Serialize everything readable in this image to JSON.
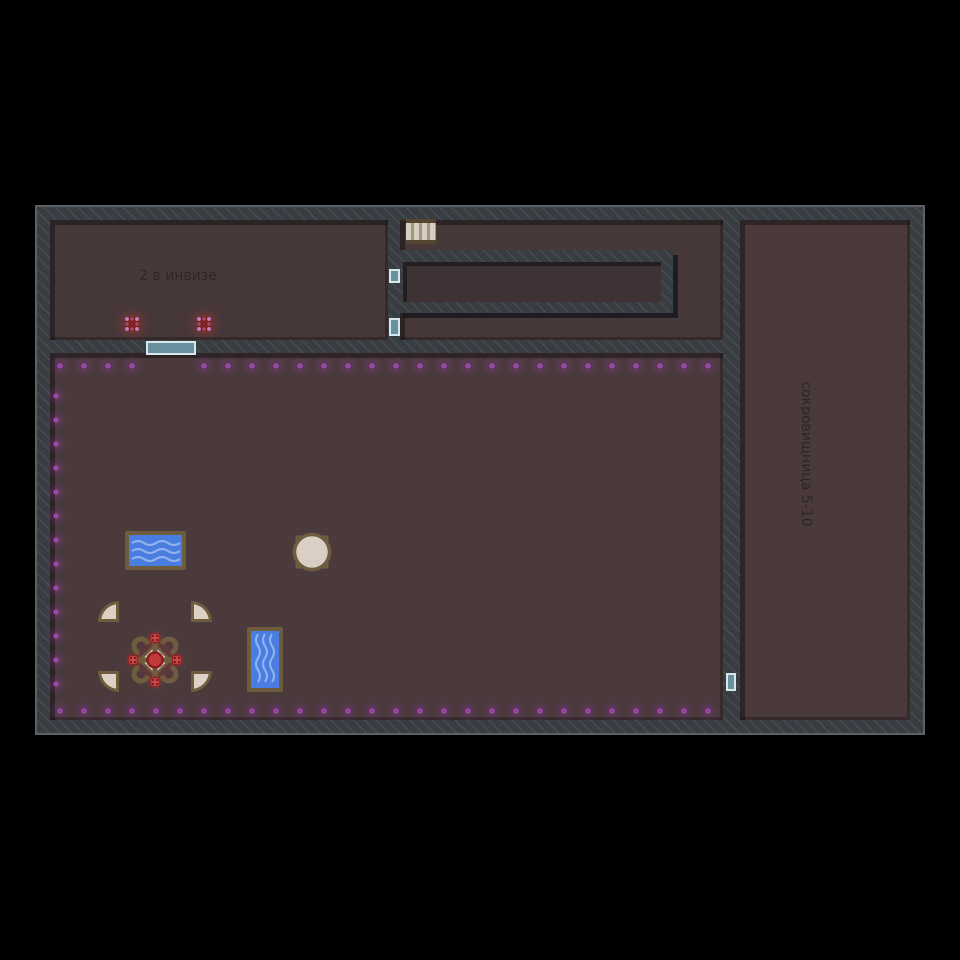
{
  "map": {
    "labels": {
      "invis_room": "2 в инвизе",
      "treasury_room": "сокровищница 5-10"
    },
    "colors": {
      "background": "#000000",
      "wall": "#383d42",
      "wall_stripe": "#4a5056",
      "floor": "#47383a",
      "chamber_floor": "#3e3235",
      "door_fill": "#67919f",
      "door_border": "#d8e7ec",
      "magic_dot": "#a94cba",
      "red_marker": "#7e2323",
      "water": "#4a7de0",
      "wood": "#6f5b3d",
      "parchment": "#dbd1c5",
      "red_glow": "#d23030"
    },
    "doors": [
      {
        "name": "main-room-south",
        "x": 146,
        "y": 341,
        "w": 50,
        "h": 14
      },
      {
        "name": "chamber-west",
        "x": 389,
        "y": 269,
        "w": 11,
        "h": 14
      },
      {
        "name": "middle-room-west",
        "x": 389,
        "y": 318,
        "w": 11,
        "h": 18
      },
      {
        "name": "treasury-west",
        "x": 726,
        "y": 673,
        "w": 10,
        "h": 18
      }
    ],
    "dot_rows": [
      {
        "axis": "x",
        "fixed": 366,
        "start": 60,
        "end": 708,
        "step": 24,
        "skip": [
          156,
          180
        ]
      },
      {
        "axis": "x",
        "fixed": 711,
        "start": 60,
        "end": 708,
        "step": 24,
        "skip": []
      },
      {
        "axis": "y",
        "fixed": 56,
        "start": 396,
        "end": 684,
        "step": 24,
        "skip": []
      }
    ],
    "invis_markers": [
      {
        "x": 132,
        "y": 324
      },
      {
        "x": 204,
        "y": 324
      }
    ]
  }
}
